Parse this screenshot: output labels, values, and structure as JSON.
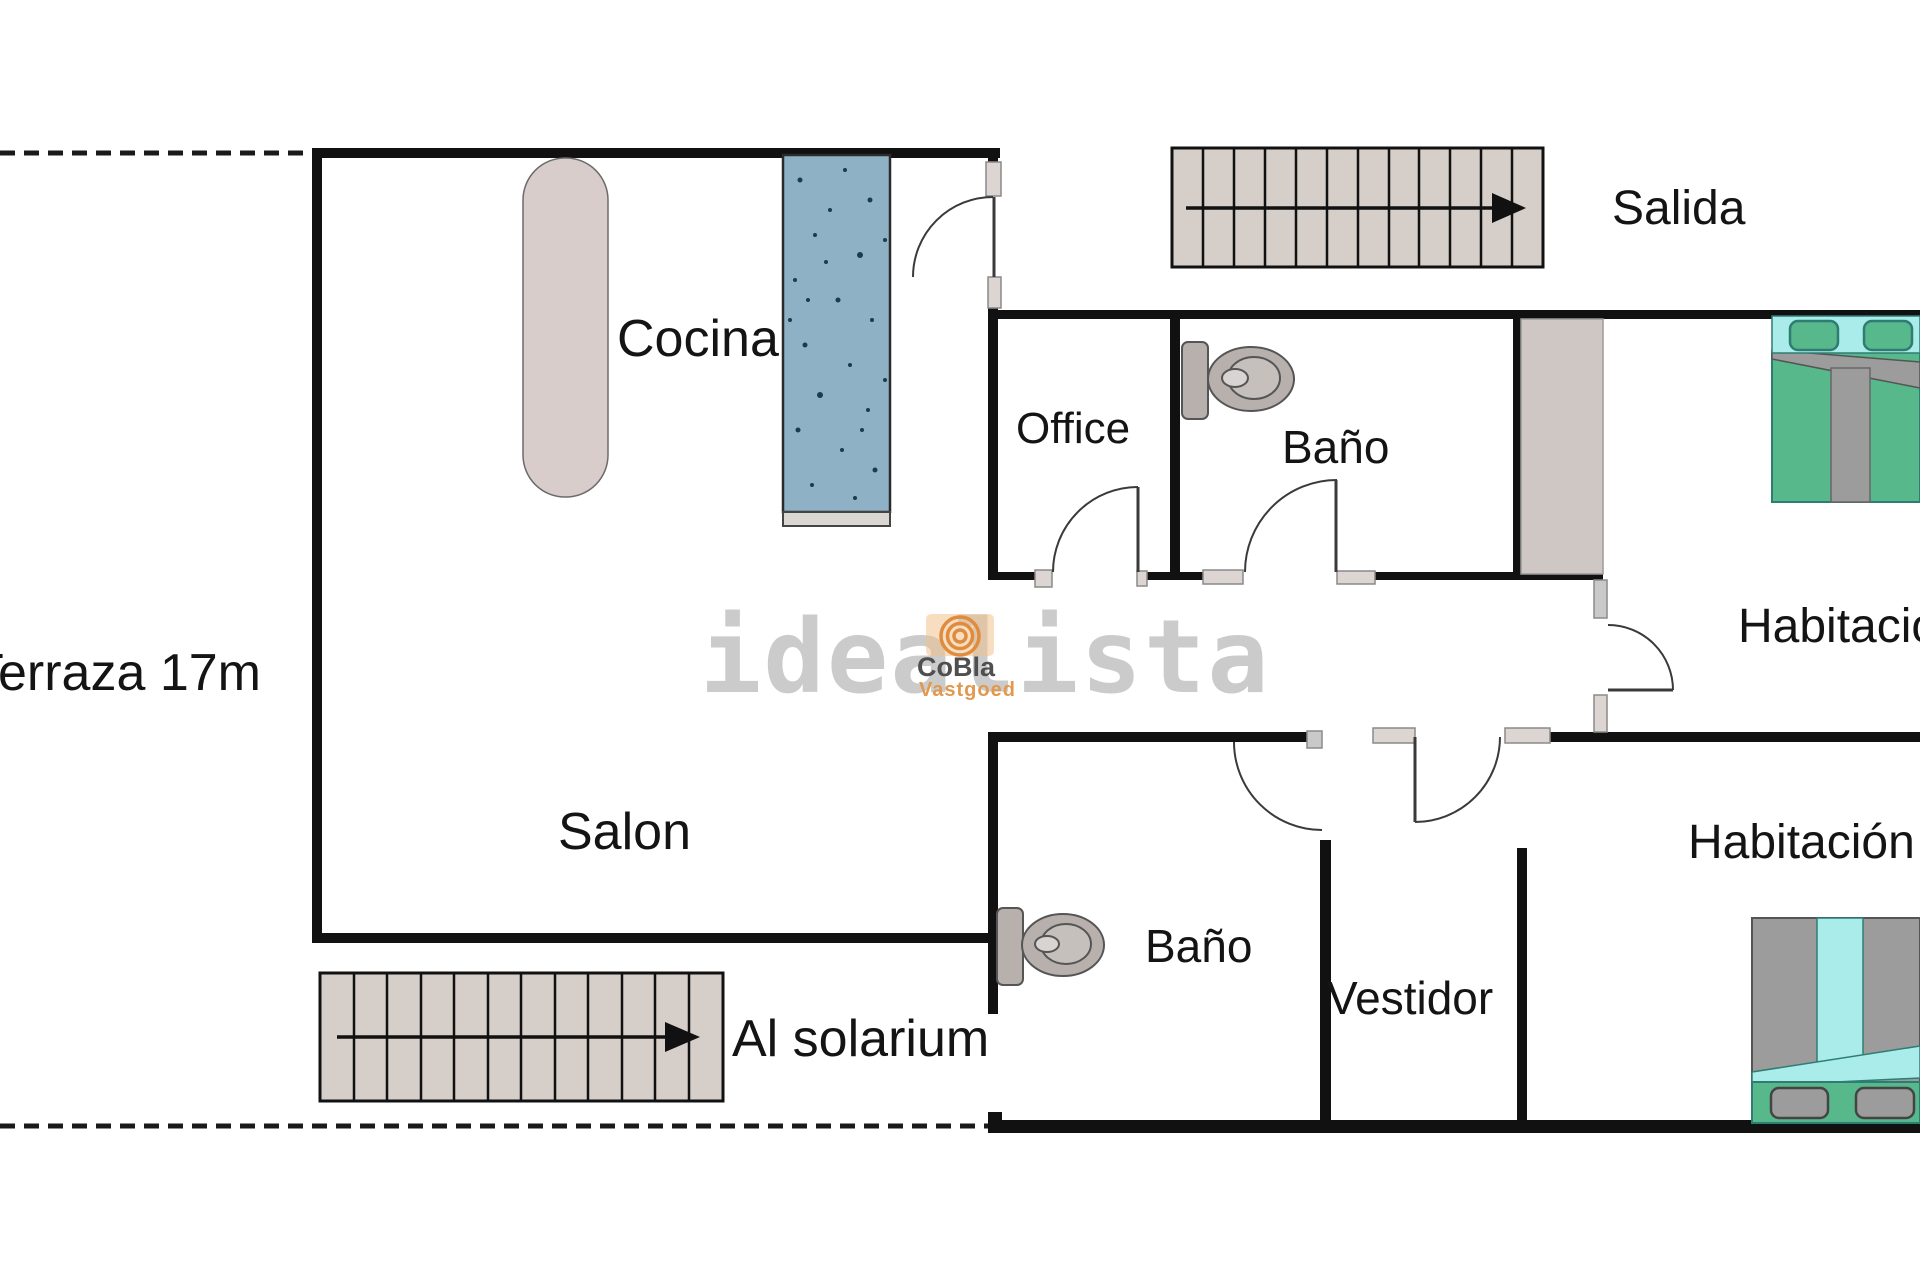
{
  "labels": {
    "terraza": "Terraza 17m",
    "cocina": "Cocina",
    "salida": "Salida",
    "office": "Office",
    "bano_top": "Baño",
    "habitacion_top": "Habitación",
    "salon": "Salon",
    "al_solarium": "Al solarium",
    "bano_bottom": "Baño",
    "vestidor": "Vestidor",
    "habitacion_bottom": "Habitación"
  },
  "watermark": {
    "brand": "idealista",
    "agency_name": "CoBla",
    "agency_tagline": "Vastgoed"
  },
  "colors": {
    "wall": "#111111",
    "stairs_fill": "#d6cec9",
    "island_fill": "#d8cdca",
    "counter_fill": "#8fb1c5",
    "counter_speckle": "#1e3a4d",
    "door_stop_beige": "#ddd5d1",
    "door_stop_gray": "#c9c9c9",
    "toilet_fill": "#b7b0ad",
    "pillar_fill": "#cfc7c3",
    "bed_green": "#57b88b",
    "bed_cyan": "#a9ece9",
    "bed_gray": "#9c9c9c",
    "bed_outline": "#2f7d72",
    "watermark_gray": "#c3c3c3",
    "brand_orange": "#e2984d"
  }
}
